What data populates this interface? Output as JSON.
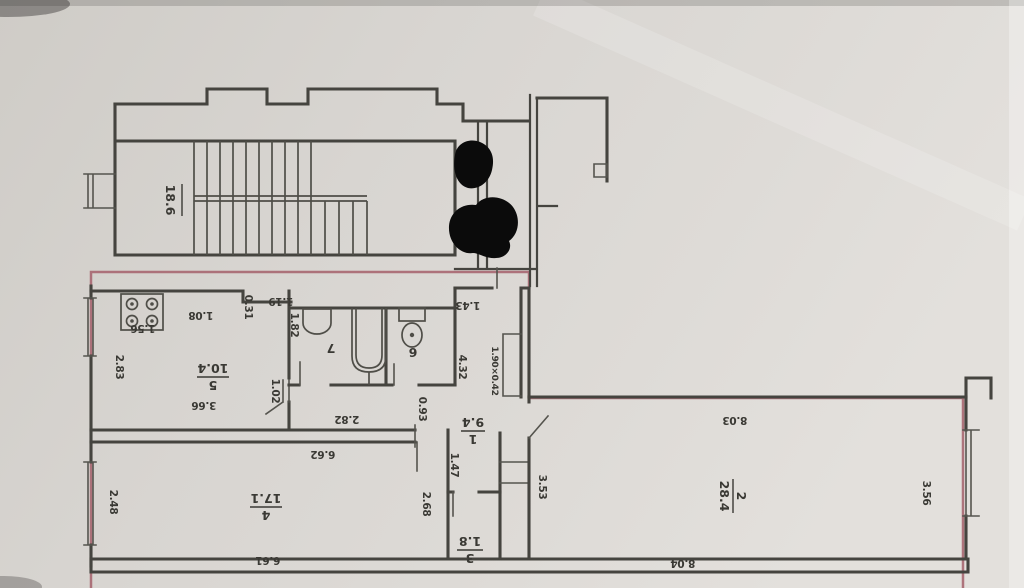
{
  "photo": {
    "kind": "scanned apartment floor plan (technical passport drawing)"
  },
  "colors": {
    "paper": "#d7d4cf",
    "ink": "#45443f",
    "text": "#3a3934",
    "highlight": "#a4606b",
    "redaction": "#0b0b0b"
  },
  "rooms": {
    "stairwell": {
      "area": "18.6"
    },
    "hall": {
      "number": "1",
      "area": "9.4"
    },
    "living": {
      "number": "2",
      "area": "28.4"
    },
    "closet": {
      "number": "3",
      "area": "1.8"
    },
    "bedroom": {
      "number": "4",
      "area": "17.1"
    },
    "kitchen": {
      "number": "5",
      "area": "10.4"
    },
    "wc": {
      "number": "6"
    },
    "bath": {
      "number": "7"
    }
  },
  "dims": {
    "kitchen_left": "2.83",
    "kitchen_stove": "1.56",
    "kitchen_top": "1.08",
    "kitchen_jog": "0.31",
    "kitchen_top2": "1.19",
    "bath_wall": "1.82",
    "kitchen_stub": "1.02",
    "kitchen_width": "3.66",
    "corridor_strip": "2.82",
    "wc_width": "0.93",
    "hall_top": "1.43",
    "hall_height": "4.32",
    "niche": "1.90×0.42",
    "hall_lower": "1.47",
    "room2_left": "3.53",
    "room4_top": "6.62",
    "room4_left": "2.48",
    "room4_right": "2.68",
    "room4_bottom": "6.61",
    "room2_top": "8.03",
    "room2_right": "3.56",
    "room2_bottom": "8.04"
  }
}
